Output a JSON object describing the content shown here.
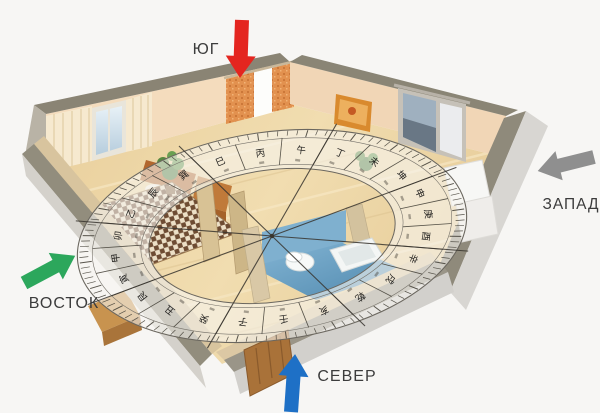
{
  "page": {
    "background": "#f7f6f4"
  },
  "directions": {
    "south": {
      "label": "ЮГ",
      "arrow_color": "#e4251f"
    },
    "west": {
      "label": "ЗАПАД",
      "arrow_color": "#8f8f8f"
    },
    "east": {
      "label": "ВОСТОК",
      "arrow_color": "#2ca75c"
    },
    "north": {
      "label": "СЕВЕР",
      "arrow_color": "#1e70c6"
    }
  },
  "compass": {
    "ring_characters": [
      "丙",
      "午",
      "丁",
      "未",
      "坤",
      "申",
      "庚",
      "酉",
      "辛",
      "戌",
      "乾",
      "亥",
      "壬",
      "子",
      "癸",
      "丑",
      "艮",
      "寅",
      "甲",
      "卯",
      "乙",
      "辰",
      "巽",
      "巳"
    ],
    "sector_count": 8,
    "tick_count": 120,
    "ring_fill": "rgba(247,245,240,0.6)",
    "line_color": "#46423a"
  }
}
